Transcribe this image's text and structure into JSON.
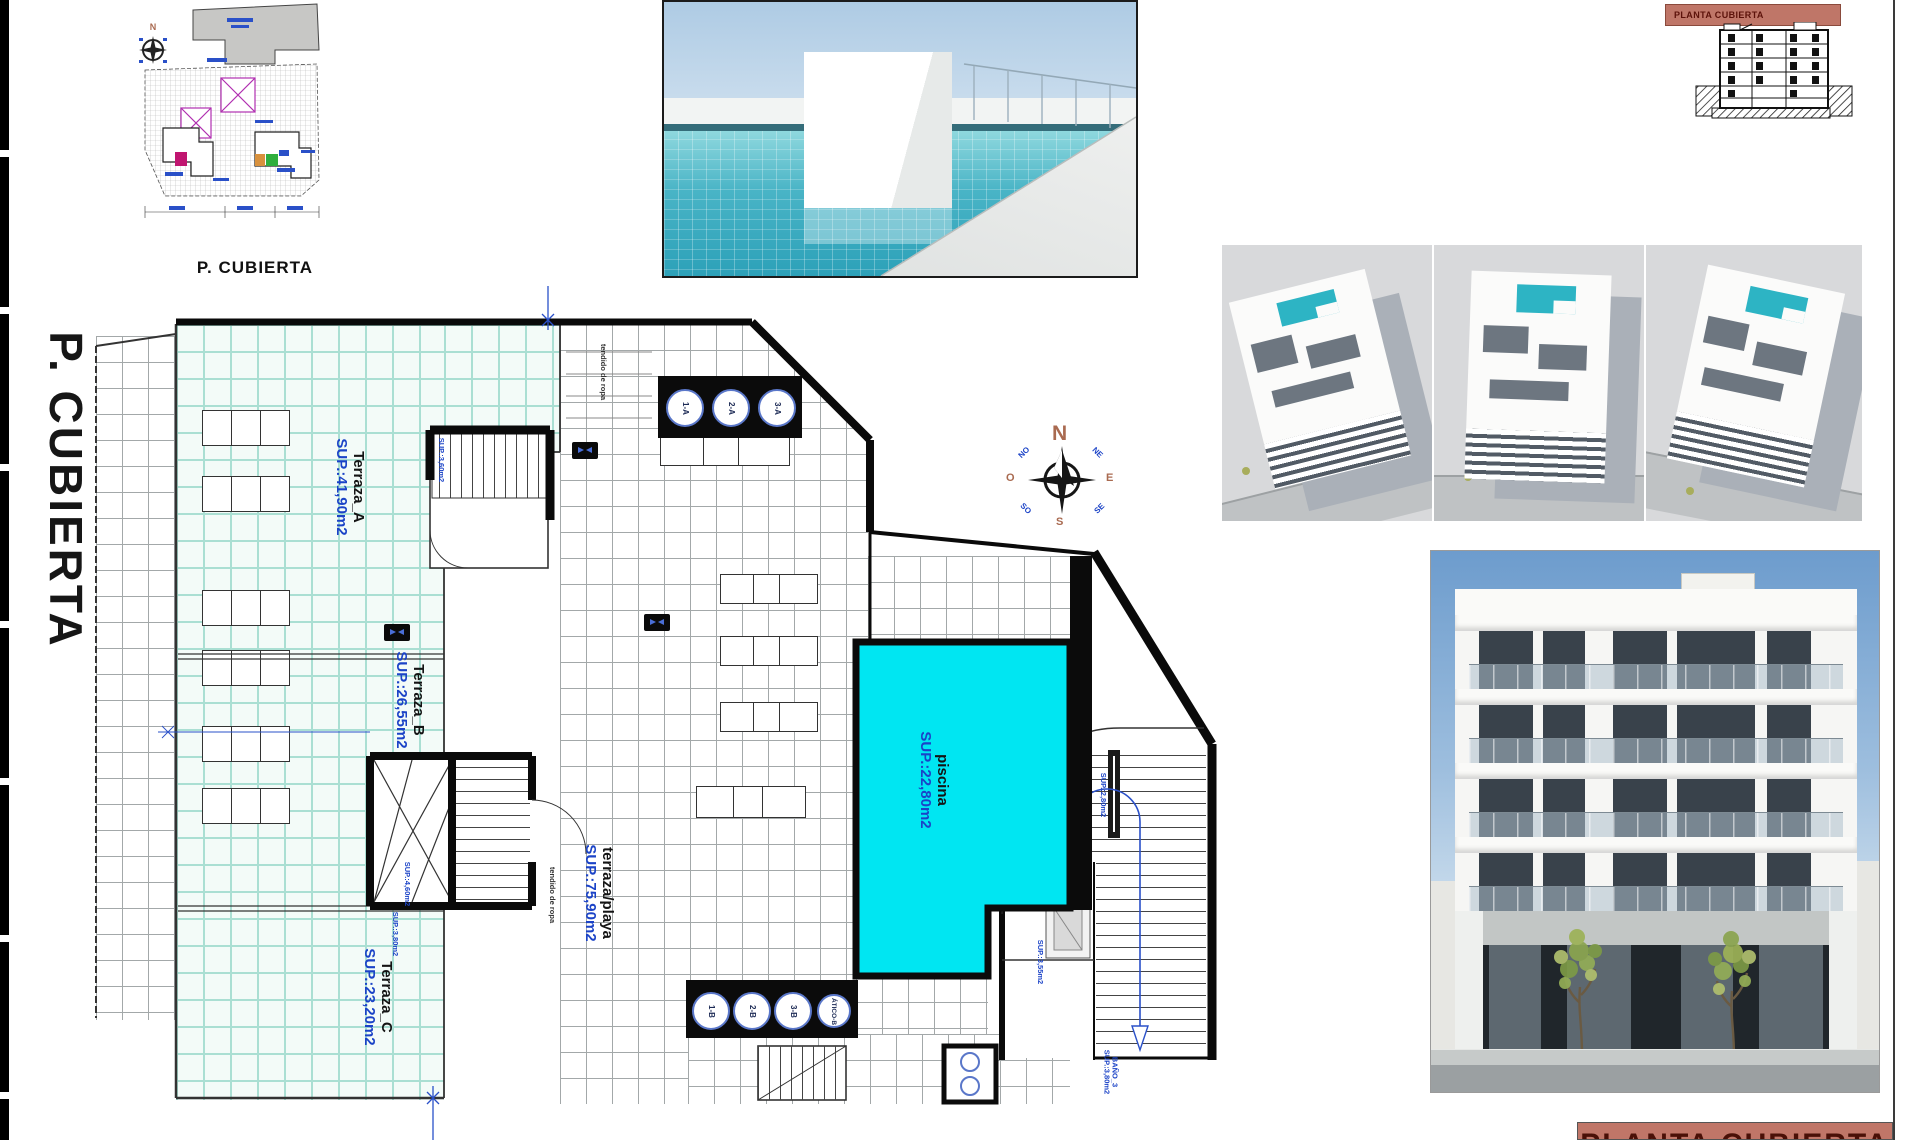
{
  "colors": {
    "plan_blue": "#1b43c7",
    "pool_cyan": "#00e6f2",
    "mint_tile": "#f3fbf8",
    "salmon_banner": "#bf7668",
    "banner_text": "#5c120a"
  },
  "side_title": "P. CUBIERTA",
  "keyplan": {
    "title": "P. CUBIERTA"
  },
  "plan": {
    "areas": {
      "a": {
        "name": "Terraza_A",
        "sup": "SUP.:41,90m2"
      },
      "b": {
        "name": "Terraza_B",
        "sup": "SUP.:26,55m2"
      },
      "c": {
        "name": "Terraza_C",
        "sup": "SUP.:23,20m2"
      },
      "playa": {
        "name": "terraza/playa",
        "sup": "SUP.:75,90m2"
      },
      "pool": {
        "name": "piscina",
        "sup": "SUP.:22,80m2"
      }
    },
    "skylights_top": [
      "1-A",
      "2-A",
      "3-A"
    ],
    "skylights_bottom": [
      "1-B",
      "2-B",
      "3-B",
      "ÁTICO-B"
    ],
    "small_labels": {
      "tendido_top": "tendido de ropa",
      "tendido_mid": "tendido de ropa",
      "core_a_sup": "SUP.:3,60m2",
      "core_b_sup1": "SUP.:4,60m2",
      "core_b_sup2": "SUP.:3,80m2",
      "stair_sup": "SUP.:2,80m2",
      "room_sup": "SUP.:3,55m2",
      "bano_name": "BAÑO_3",
      "bano_sup": "SUP.:3,80m2"
    },
    "compass": {
      "n": "N",
      "ne": "NE",
      "e": "E",
      "se": "SE",
      "s": "S",
      "so": "SO",
      "o": "O",
      "no": "NO"
    }
  },
  "section_panel": {
    "banner": "PLANTA CUBIERTA"
  },
  "title_block": {
    "label": "PLANTA CUBIERTA"
  }
}
